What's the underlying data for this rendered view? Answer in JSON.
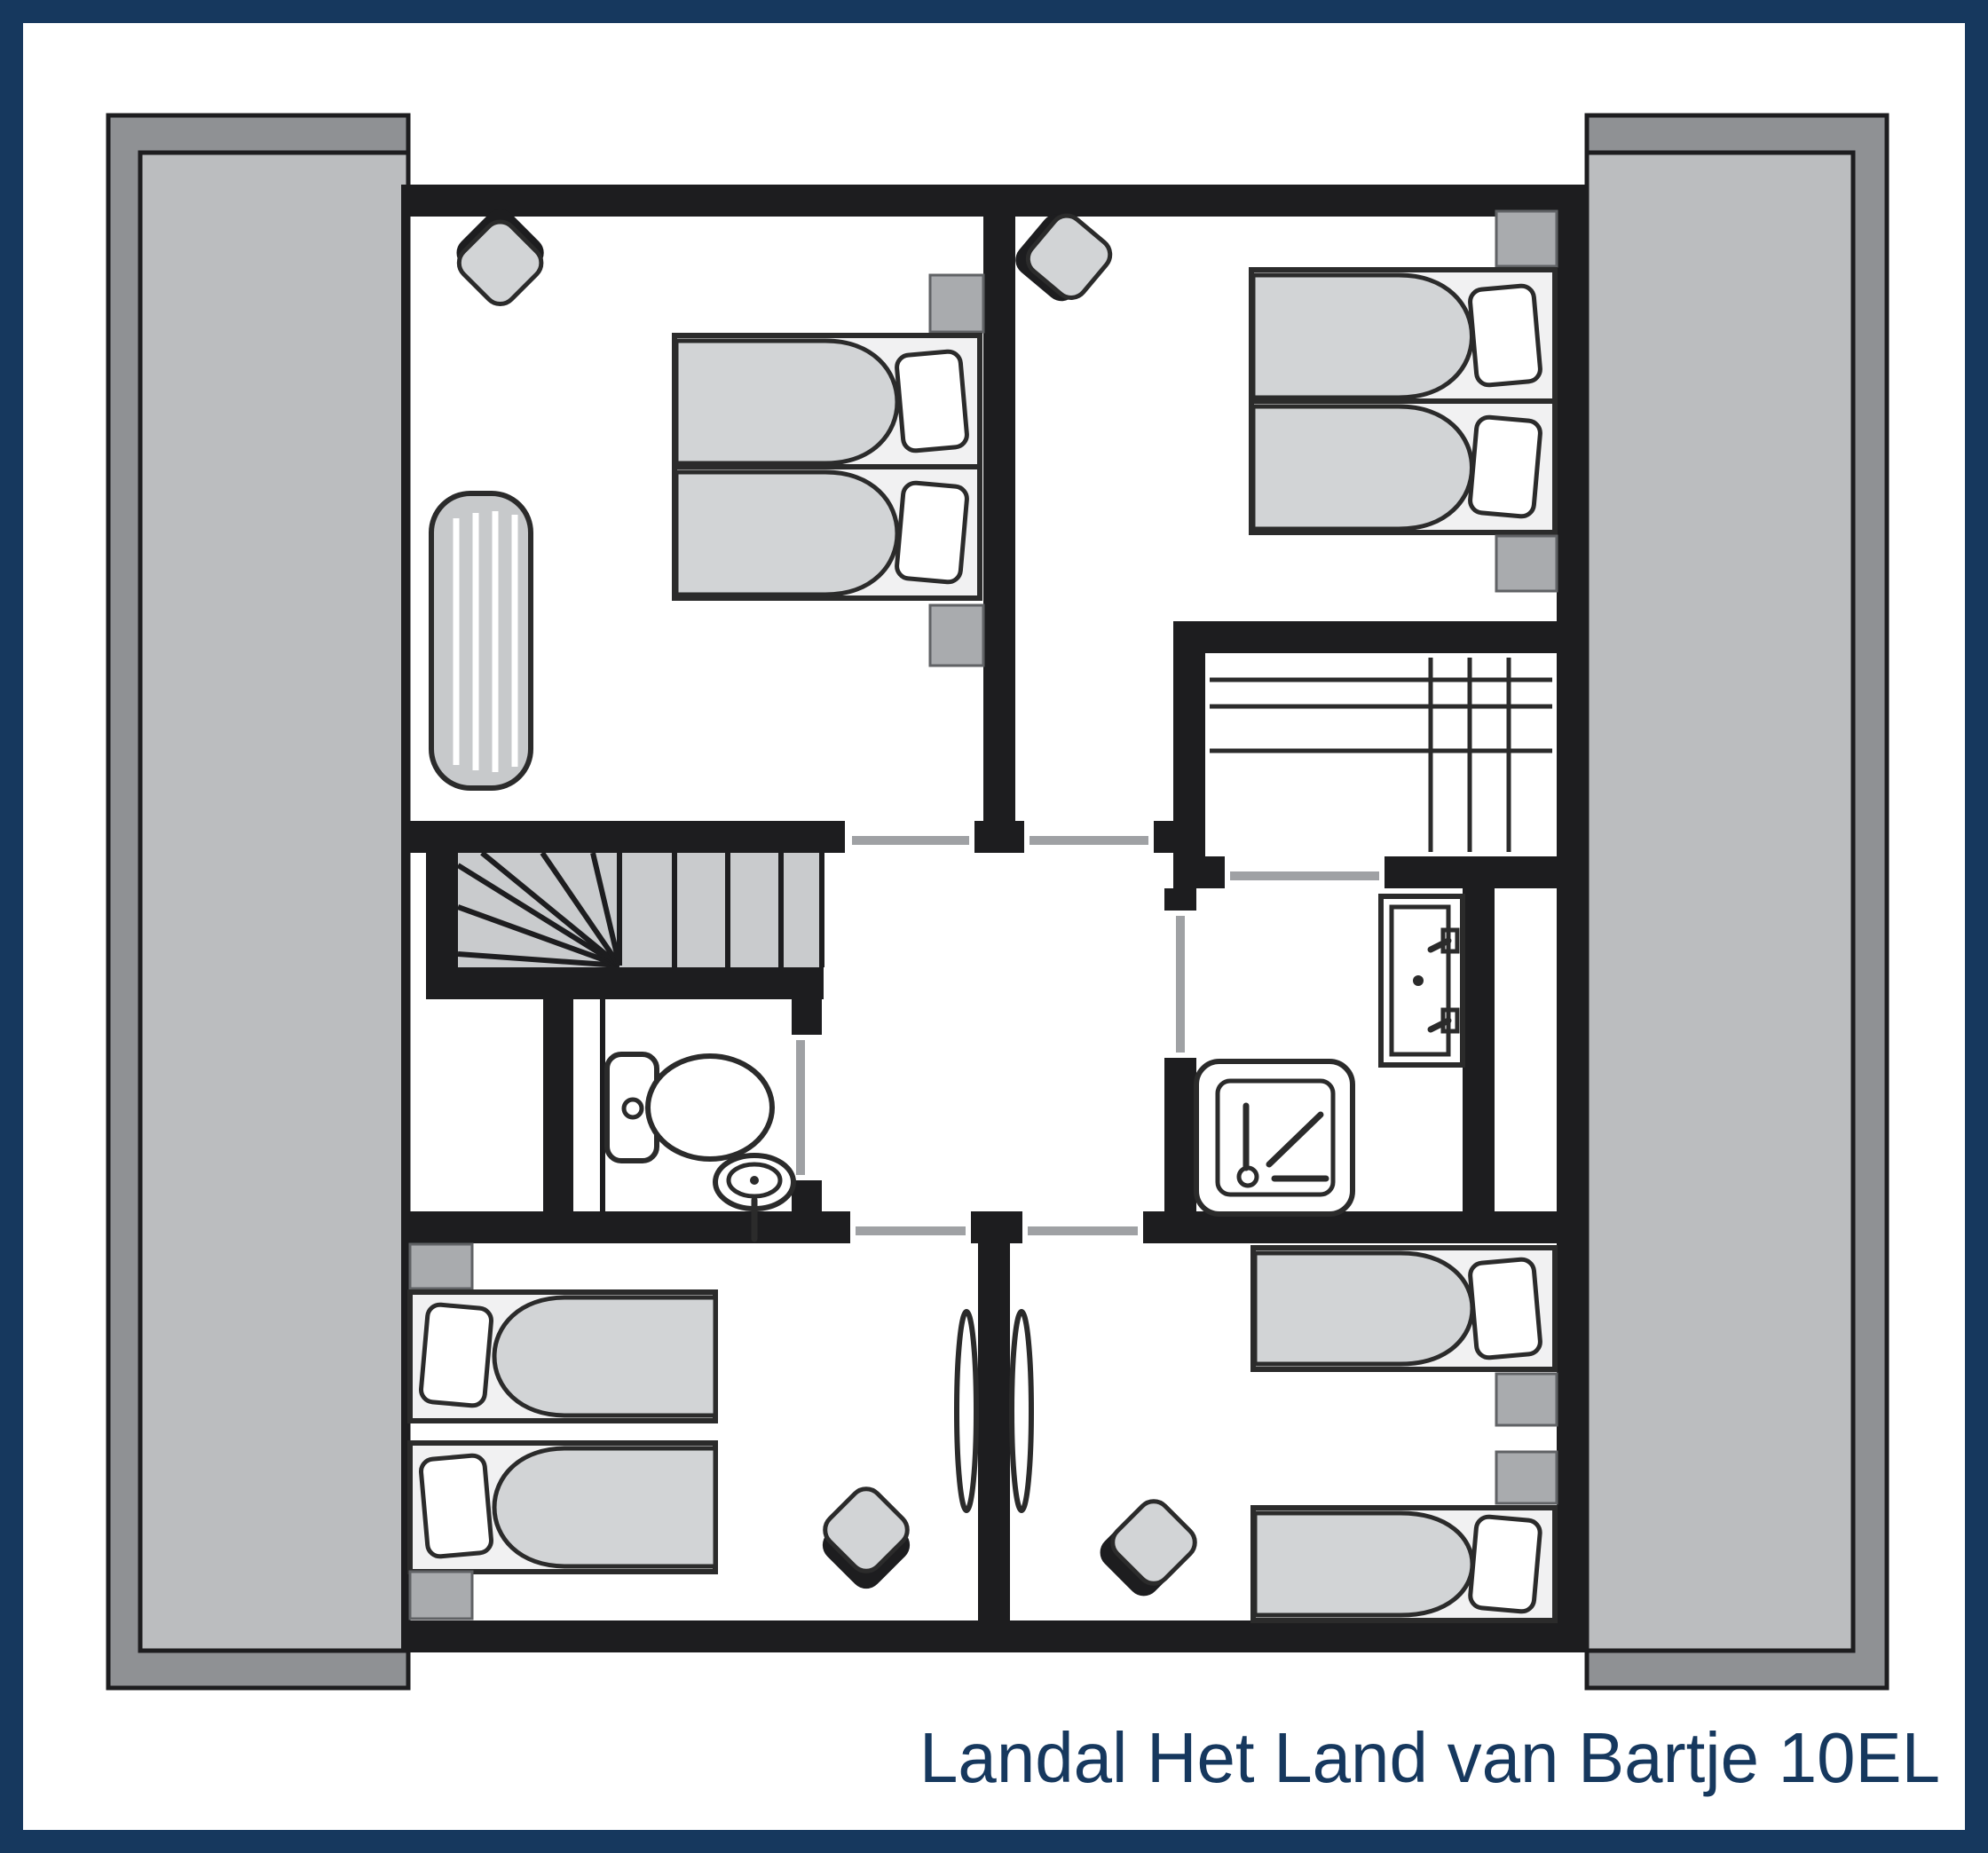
{
  "caption": {
    "text": "Landal Het Land van Bartje 10EL"
  },
  "theme": {
    "navy": "#16385E",
    "wall": "#1D1D1F",
    "paper": "#FFFFFF",
    "roof-outer": "#8F9194",
    "roof-inner": "#BBBDBF",
    "furniture": "#D2D4D6",
    "bedframe": "#F1F1F2",
    "nightstand": "#A9ABAE",
    "tread": "#C9CBCD",
    "mat": "#C7C9CB",
    "doorline": "#9FA1A4",
    "line": "#2B2B2B"
  },
  "floorplan": {
    "rooms": [
      {
        "name": "bedroom-top-left",
        "furniture": [
          "single-bed",
          "single-bed",
          "cot-mattress",
          "stool",
          "nightstand",
          "nightstand"
        ]
      },
      {
        "name": "bedroom-top-right",
        "furniture": [
          "single-bed",
          "single-bed",
          "stool",
          "nightstand",
          "nightstand"
        ]
      },
      {
        "name": "wardrobe-closet",
        "furniture": [
          "shelving-unit"
        ]
      },
      {
        "name": "landing-hall",
        "furniture": [
          "winder-staircase"
        ]
      },
      {
        "name": "toilet-room",
        "furniture": [
          "toilet",
          "hand-basin"
        ]
      },
      {
        "name": "bathroom",
        "furniture": [
          "shower-tray",
          "washbasin-vanity"
        ]
      },
      {
        "name": "bedroom-bottom-left",
        "furniture": [
          "single-bed",
          "single-bed",
          "stool",
          "nightstand",
          "nightstand"
        ]
      },
      {
        "name": "bedroom-bottom-right",
        "furniture": [
          "single-bed",
          "single-bed",
          "stool",
          "nightstand",
          "nightstand"
        ]
      }
    ],
    "roof_slopes": [
      "roof-slope-left",
      "roof-slope-right"
    ],
    "doors": [
      "bedroom-top-left-door",
      "bedroom-top-right-door",
      "closet-door",
      "toilet-door",
      "bathroom-door",
      "bedroom-bottom-left-door",
      "bedroom-bottom-right-door"
    ]
  }
}
